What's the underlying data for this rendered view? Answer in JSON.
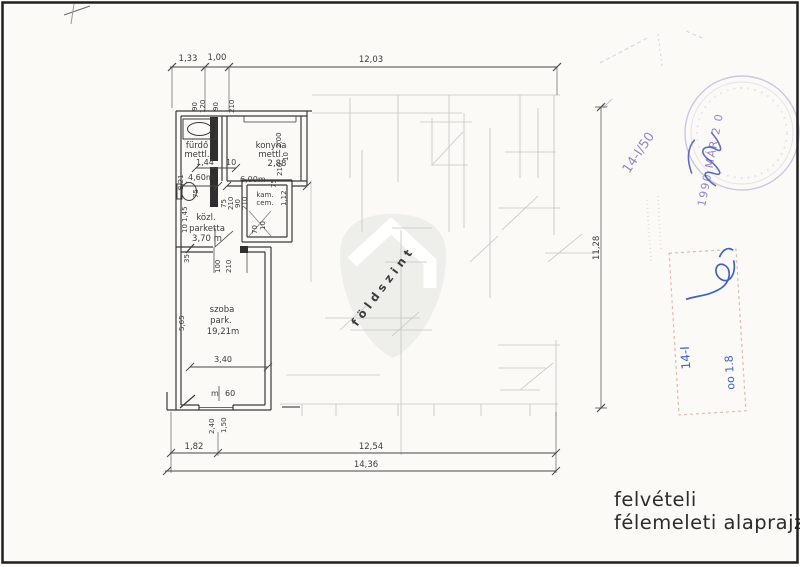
{
  "title_block": {
    "line1": "felvételi",
    "line2": "félemeleti alaprajz"
  },
  "watermark": {
    "label": "földszint"
  },
  "stamp": {
    "date": "1990 MÁR 2 0",
    "ref": "14-I/50"
  },
  "note_box": {
    "code": "14-I",
    "number": "oo 1.8"
  },
  "plan": {
    "rooms": {
      "bath": {
        "l1": "fürdő",
        "l2": "mettl."
      },
      "kitchen": {
        "l1": "konyha",
        "l2": "mettl.",
        "l3": "2,88"
      },
      "hall": {
        "l1": "közl.",
        "l2": "parketta",
        "l3": "3,70 m"
      },
      "pantry": {
        "l1": "kam.",
        "l2": "cem."
      },
      "room": {
        "l1": "szoba",
        "l2": "park.",
        "l3": "19,21m"
      }
    },
    "dims": {
      "top": [
        "1,33",
        "1,00",
        "12,03"
      ],
      "bottom": [
        "1,82",
        "12,54",
        "14,36"
      ],
      "right": "11,28",
      "top_vert": [
        "90",
        "120",
        "90",
        "210"
      ],
      "inner": {
        "d144": "1,44",
        "d10a": "10",
        "d460": "4,60m",
        "d600": "6,00m",
        "d200": "2,00",
        "d112": "1,12",
        "d321": "3,21",
        "d145": "1,45",
        "d10b": "10",
        "d35": "35",
        "d565": "5,65",
        "d340": "3,40",
        "dm": "m",
        "d60": "60",
        "d100": "100",
        "d210door": "210",
        "d240": "2,40",
        "d150": "1,50",
        "d70": "70",
        "d10c": "10",
        "p75a": "75",
        "p210a": "210",
        "p90a": "90",
        "p210b": "210",
        "p75b": "75",
        "p210c": "210",
        "p10": "10",
        "p75c": "75"
      }
    }
  },
  "colors": {
    "ink": "#3a3a3a",
    "faint": "#c4c4c2",
    "stamp": "#a89bd1",
    "pen": "#3f63c0",
    "box": "#dcafa6",
    "shield": "#ebebe8"
  }
}
